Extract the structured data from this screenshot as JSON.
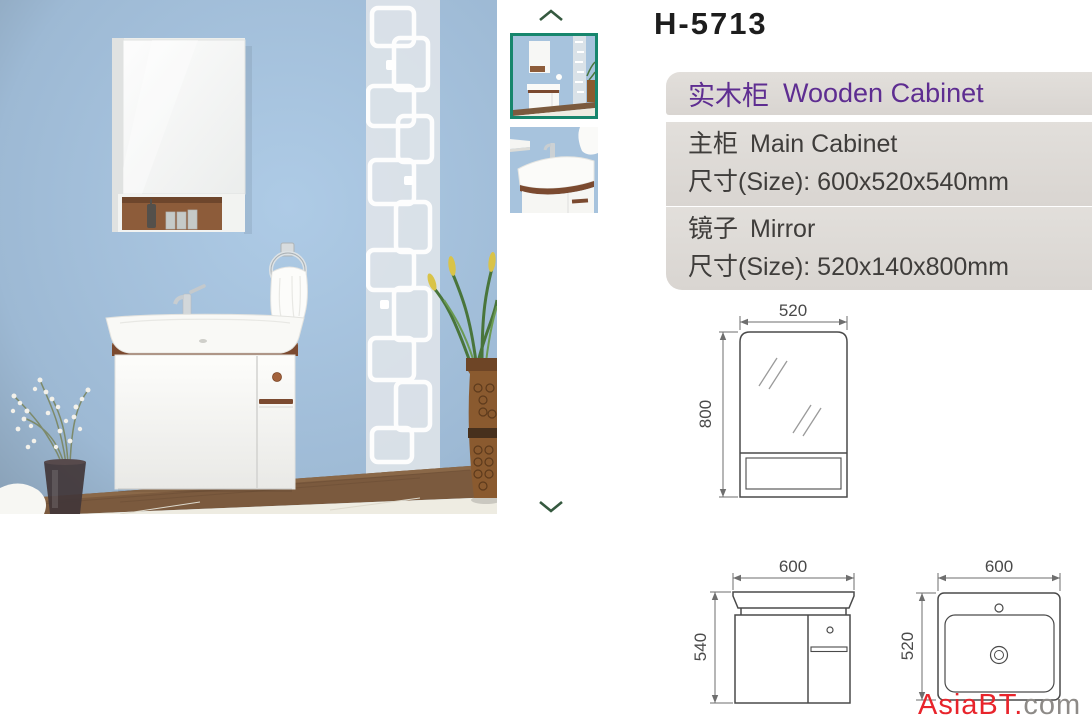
{
  "page": {
    "title": "H-5713"
  },
  "gallery": {
    "up_icon": "chevron-up",
    "down_icon": "chevron-down",
    "thumbnails": [
      {
        "label": "product-overview",
        "selected": true
      },
      {
        "label": "basin-closeup",
        "selected": false
      }
    ]
  },
  "info": {
    "header": {
      "zh": "实木柜",
      "en": "Wooden Cabinet"
    },
    "sections": [
      {
        "zh": "主柜",
        "en": "Main Cabinet",
        "size": "尺寸(Size): 600x520x540mm"
      },
      {
        "zh": "镜子",
        "en": "Mirror",
        "size": "尺寸(Size): 520x140x800mm"
      }
    ]
  },
  "diagrams": {
    "mirror": {
      "width_mm": "520",
      "height_mm": "800"
    },
    "cabinet": {
      "width_mm": "600",
      "height_mm": "540"
    },
    "basin": {
      "width_mm": "600",
      "depth_mm": "520"
    }
  },
  "watermark": {
    "brand": "AsiaBT",
    "dot": ".",
    "tld": "com"
  },
  "colors": {
    "accent_purple": "#5e2d91",
    "band_bg": "#dedad7",
    "thumb_border": "#17866d",
    "arrow_green": "#35593f",
    "watermark_red": "#e8242b",
    "watermark_gray": "#8d8a87",
    "wall_blue": "#a7c3dd",
    "wood_brown": "#7b4a30"
  }
}
